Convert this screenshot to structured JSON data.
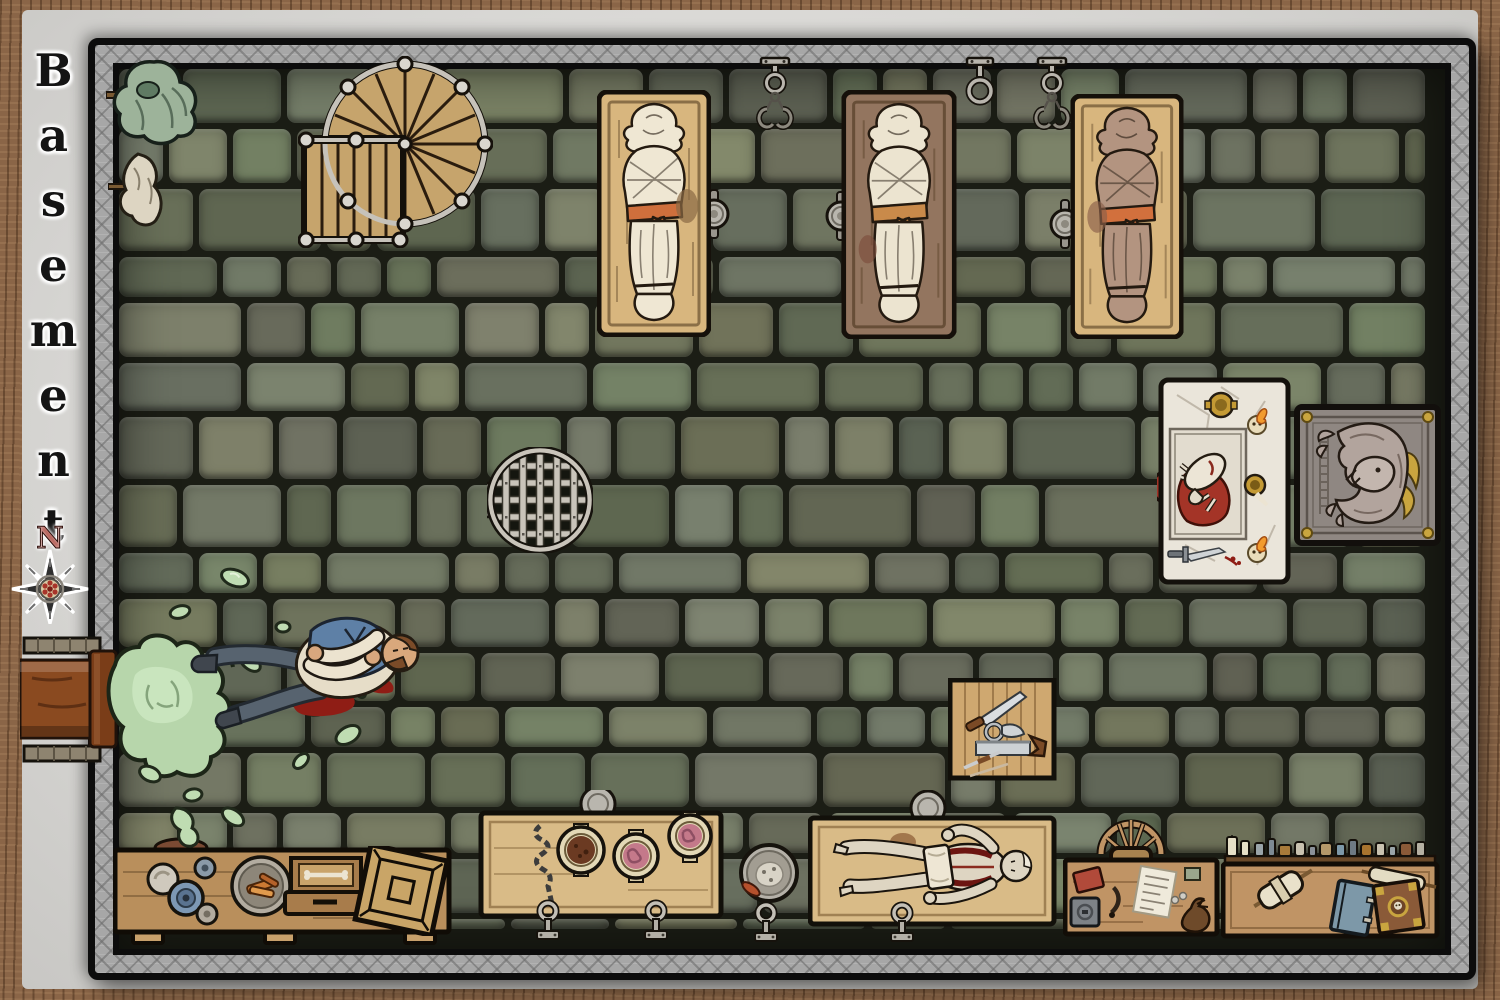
{
  "map": {
    "title": "Basement",
    "compass_north": "N"
  },
  "palette": {
    "paper_margin": "#dbdad7",
    "wood_frame": "#8a6547",
    "metal_wall": "#a7a7a7",
    "floor_tile": "#6b6e5f",
    "floor_gap": "#1b1d15",
    "bench_wood": "#c09465",
    "pale_slab_wood": "#d8b67e",
    "dark_slab_wood": "#93755f",
    "shroud_cloth": "#efe7d3",
    "brown_shroud": "#b39480",
    "sash_orange": "#cf6f3c",
    "slime_green": "#bcdab0",
    "blood_red": "#8f1d15",
    "marble_altar": "#eae5da",
    "gold_accent": "#c9a33f",
    "compass_north_red": "#9e2b20"
  },
  "objects": [
    {
      "name": "spiral-staircase",
      "desc": "wooden spiral staircase with metal railing"
    },
    {
      "name": "hanging-cloak",
      "desc": "green cloak hung on wall peg"
    },
    {
      "name": "hanging-rag",
      "desc": "white cloth hung on wall peg"
    },
    {
      "name": "mortuary-slab-1",
      "desc": "shrouded corpse with orange sash on pale wooden slab"
    },
    {
      "name": "mortuary-slab-2",
      "desc": "shrouded corpse on dark wooden slab"
    },
    {
      "name": "mortuary-slab-3",
      "desc": "brown-shrouded corpse on pale wooden slab"
    },
    {
      "name": "ceiling-hook-left",
      "desc": "ceiling mount with ring and double meat hooks"
    },
    {
      "name": "ceiling-ring",
      "desc": "ceiling mount with empty ring"
    },
    {
      "name": "ceiling-hook-right",
      "desc": "ceiling mount with ring and double meat hooks"
    },
    {
      "name": "floor-drain",
      "desc": "round iron drain grate with hinge and latch"
    },
    {
      "name": "ritual-altar",
      "desc": "marble altar with sacrificed goat on red cloth, chalice, skull candles and dagger"
    },
    {
      "name": "demon-plaque",
      "desc": "stone relief plaque of a horned demon with gold corners"
    },
    {
      "name": "slime-victim",
      "desc": "dead man lying in green slime with blood pools"
    },
    {
      "name": "wall-pipe",
      "desc": "rusty wall pipe leaking green slime"
    },
    {
      "name": "workbench-dishes",
      "desc": "workbench with plates, blue bowl, platter of meat and bone box"
    },
    {
      "name": "crate",
      "desc": "tilted wooden crate"
    },
    {
      "name": "specimen-bench",
      "desc": "bench with chain and three open jars of preserved organs"
    },
    {
      "name": "scrap-plate",
      "desc": "metal platter of scraps on the floor"
    },
    {
      "name": "autopsy-table",
      "desc": "dissected pale corpse on wooden table with basin"
    },
    {
      "name": "surgical-tools-table",
      "desc": "square table with knife, bone saws and scalpel"
    },
    {
      "name": "writing-desk",
      "desc": "desk with red book, quill, paper, coins, pouch and strongbox"
    },
    {
      "name": "desk-chair",
      "desc": "wooden spindle-back chair"
    },
    {
      "name": "alchemy-bench",
      "desc": "bench with shelf of bottles, scrolls, blue book and skull-emblem book"
    },
    {
      "name": "floor-anchor",
      "desc": "iron eye-bolt floor anchor"
    }
  ]
}
